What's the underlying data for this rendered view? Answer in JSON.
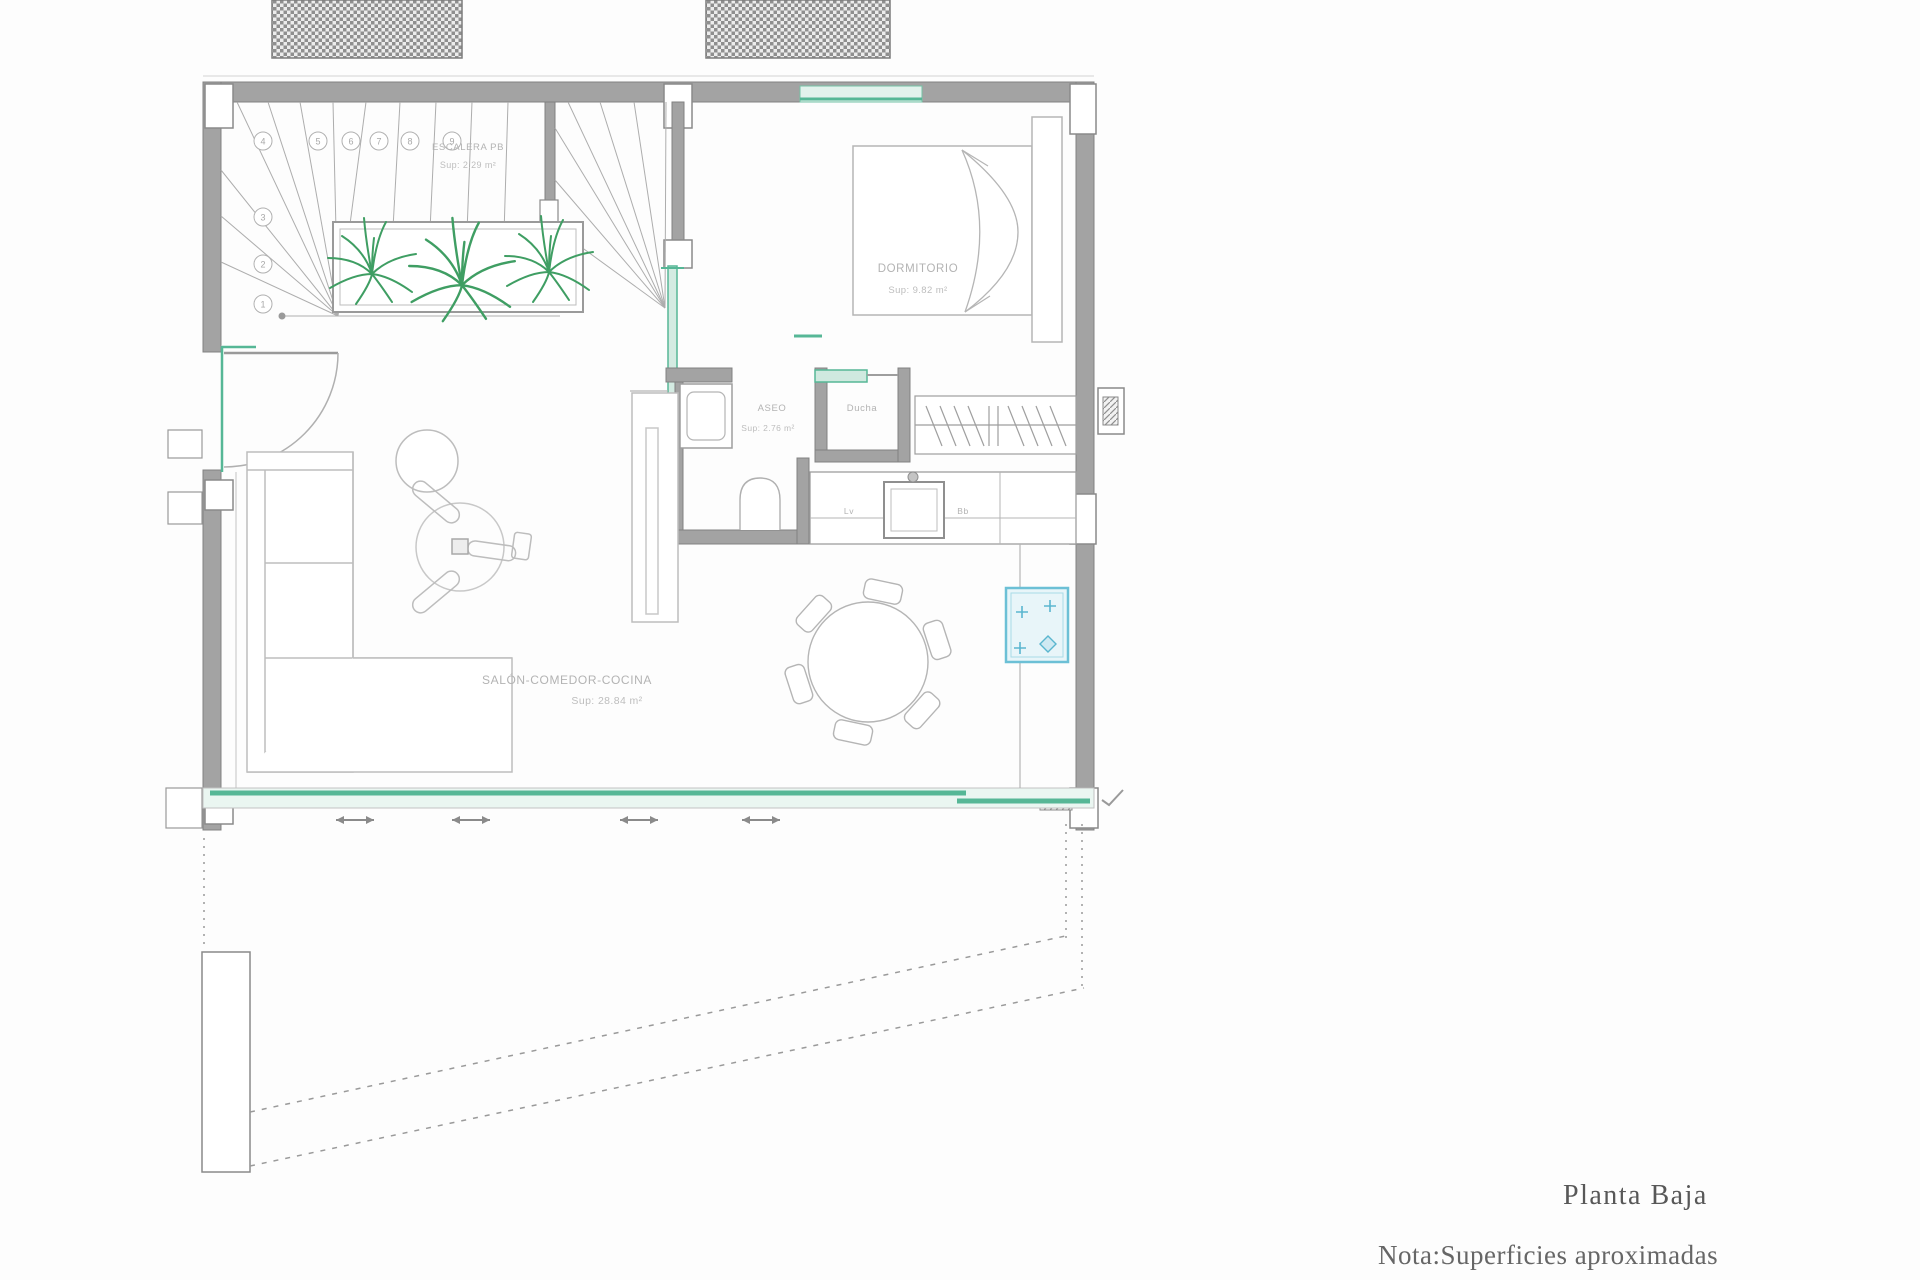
{
  "plan": {
    "title": "Planta Baja",
    "note": "Nota:Superficies aproximadas"
  },
  "rooms": {
    "stairs": {
      "name": "ESCALERA PB",
      "area": "Sup: 2.29 m²"
    },
    "bedroom": {
      "name": "DORMITORIO",
      "area": "Sup: 9.82 m²"
    },
    "bathroom": {
      "name": "ASEO",
      "area": "Sup: 2.76 m²"
    },
    "shower": {
      "name": "Ducha"
    },
    "living": {
      "name": "SALÓN-COMEDOR-COCINA",
      "area": "Sup: 28.84 m²"
    }
  },
  "kitchen": {
    "label_lv": "Lv",
    "label_bb": "Bb"
  },
  "stair_steps": [
    "1",
    "2",
    "3",
    "4",
    "5",
    "6",
    "7",
    "8",
    "9"
  ],
  "colors": {
    "wall_gray": "#a3a3a3",
    "line_gray": "#b5b5b5",
    "window_teal": "#56b796",
    "plant_green": "#3f9e63",
    "cooktop_cyan": "#5ab6cf",
    "label_gray": "#b3b3b3",
    "caption_gray": "#5f5f5f"
  }
}
